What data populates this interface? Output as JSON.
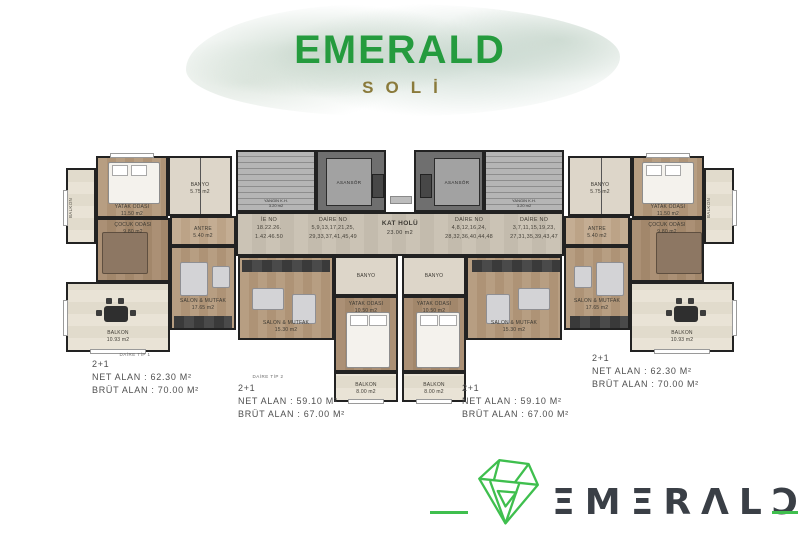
{
  "header": {
    "title": "EMERALD",
    "subtitle": "SOLİ"
  },
  "floor_plan": {
    "hall_label": {
      "name": "KAT HOLÜ",
      "area": "23.00 m2"
    },
    "elevator_label": "ASANSÖR",
    "fire_stair_label": {
      "name": "YANGIN K.H.",
      "area": "3.20 m2"
    },
    "unit_numbers": [
      {
        "line1": "İE NO",
        "line2": "18.22.26.",
        "line3": "1.42.46.50"
      },
      {
        "line1": "DAİRE NO",
        "line2": "5,9,13,17,21,25,",
        "line3": "29,33,37,41,45,49"
      },
      {
        "line1": "DAİRE NO",
        "line2": "4,8,12,16,24,",
        "line3": "28,32,36,40,44,48"
      },
      {
        "line1": "DAİRE NO",
        "line2": "3,7,11,15,19,23,",
        "line3": "27,31,35,39,43,47"
      }
    ],
    "rooms": {
      "master_bedroom": {
        "name": "YATAK ODASI",
        "area": "11.50 m2"
      },
      "kids_room": {
        "name": "ÇOCUK ODASI",
        "area": "9.80 m2"
      },
      "living_outer": {
        "name": "SALON & MUTFAK",
        "area": "17.65 m2"
      },
      "living_inner": {
        "name": "SALON & MUTFAK",
        "area": "15.30 m2"
      },
      "bedroom_inner": {
        "name": "YATAK ODASI",
        "area": "10.50 m2"
      },
      "balcony_outer": {
        "name": "BALKON",
        "area": "10.93 m2"
      },
      "balcony_inner": {
        "name": "BALKON",
        "area": "8.00 m2"
      },
      "balcony_side": {
        "name": "BALKON",
        "area": "2.88 m2"
      },
      "bathroom": {
        "name": "BANYO",
        "area": "5.75 m2"
      },
      "antre": {
        "name": "ANTRE",
        "area": "5.40 m2"
      }
    }
  },
  "units": [
    {
      "tip": "DAİRE TİP 1",
      "type": "2+1",
      "net": "NET ALAN : 62.30 M²",
      "brut": "BRÜT ALAN : 70.00 M²"
    },
    {
      "tip": "DAİRE TİP 2",
      "type": "2+1",
      "net": "NET ALAN : 59.10 M²",
      "brut": "BRÜT ALAN : 67.00 M²"
    },
    {
      "type": "2+1",
      "net": "NET ALAN : 59.10 M²",
      "brut": "BRÜT ALAN : 67.00 M²"
    },
    {
      "type": "2+1",
      "net": "NET ALAN : 62.30 M²",
      "brut": "BRÜT ALAN : 70.00 M²"
    }
  ],
  "footer": {
    "brand": "EMERALD",
    "brand_display": "ΞMΞRΛLƆ"
  },
  "colors": {
    "brand_green": "#259b3e",
    "logo_green": "#3fbf4e",
    "soli_gold": "#8a7a3b",
    "logo_gray": "#3a3f46"
  }
}
